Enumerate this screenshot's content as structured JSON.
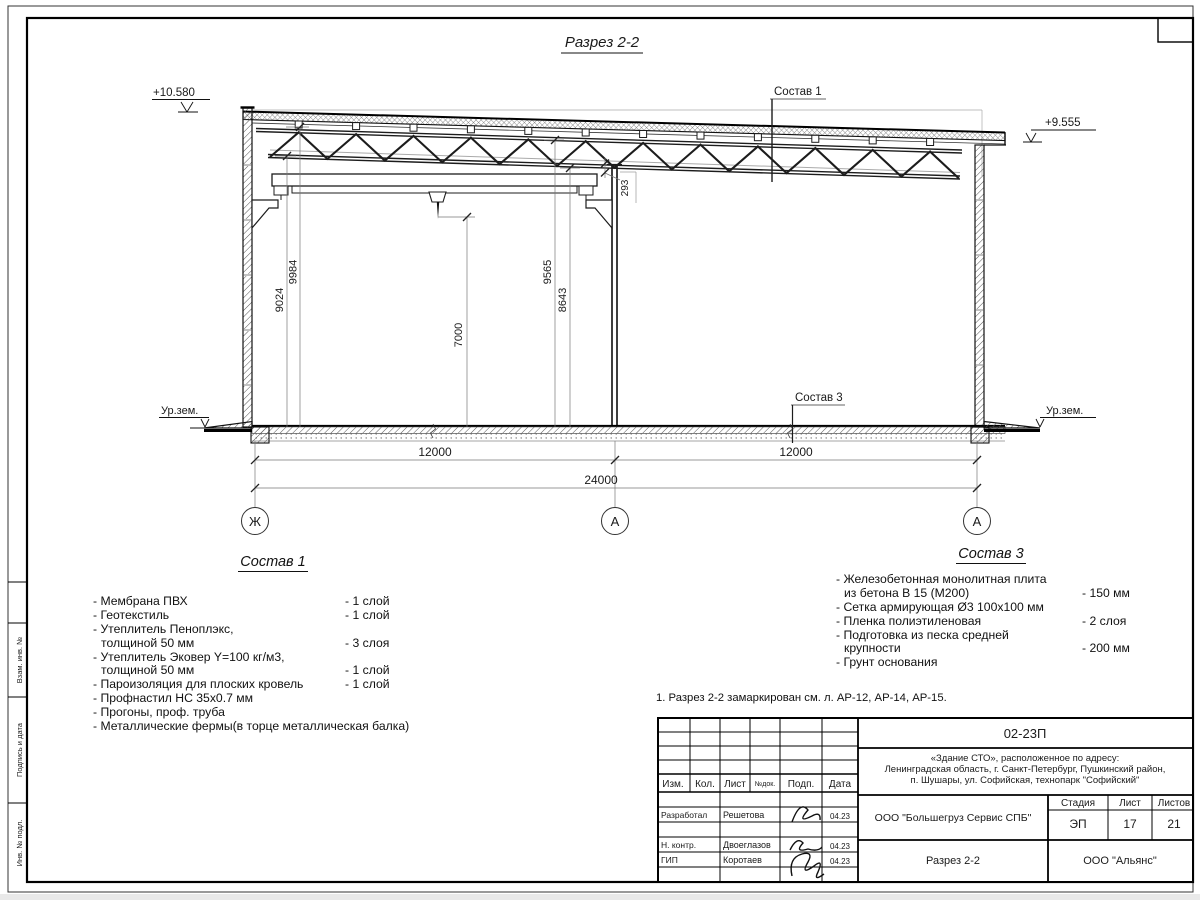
{
  "sheet": {
    "margin_labels": [
      "Взам. инв. №",
      "Подпись и дата",
      "Инв. № подл."
    ]
  },
  "drawing": {
    "title": "Разрез 2-2",
    "elev_left": "+10.580",
    "elev_right": "+9.555",
    "ground_left": "Ур.зем.",
    "ground_right": "Ур.зем.",
    "callout_roof": "Состав 1",
    "callout_floor": "Состав 3",
    "dims": {
      "v9024": "9024",
      "v9984": "9984",
      "v7000": "7000",
      "v9565": "9565",
      "v8643": "8643",
      "v293": "293",
      "bay1": "12000",
      "bay2": "12000",
      "total": "24000"
    },
    "grids": [
      "Ж",
      "А",
      "А"
    ]
  },
  "comp1": {
    "title": "Состав 1",
    "rows": [
      {
        "n": "- Мембрана ПВХ",
        "q": "- 1 слой"
      },
      {
        "n": "- Геотекстиль",
        "q": "- 1 слой"
      },
      {
        "n": "- Утеплитель Пеноплэкс,",
        "q": ""
      },
      {
        "n": "толщиной 50 мм",
        "q": "- 3 слоя"
      },
      {
        "n": "- Утеплитель Эковер Y=100 кг/м3,",
        "q": ""
      },
      {
        "n": "толщиной 50 мм",
        "q": "- 1 слой"
      },
      {
        "n": "- Пароизоляция для плоских кровель",
        "q": "- 1 слой"
      },
      {
        "n": "- Профнастил НС 35х0.7 мм",
        "q": ""
      },
      {
        "n": "- Прогоны, проф. труба",
        "q": ""
      },
      {
        "n": "- Металлические фермы(в торце металлическая балка)",
        "q": ""
      }
    ]
  },
  "comp3": {
    "title": "Состав 3",
    "rows": [
      {
        "n": "- Железобетонная  монолитная плита",
        "q": ""
      },
      {
        "n": "из бетона В 15 (М200)",
        "q": "- 150 мм"
      },
      {
        "n": "- Сетка армирующая Ø3 100х100 мм",
        "q": ""
      },
      {
        "n": "- Пленка полиэтиленовая",
        "q": "-  2 слоя"
      },
      {
        "n": "- Подготовка из песка средней",
        "q": ""
      },
      {
        "n": "крупности",
        "q": "- 200 мм"
      },
      {
        "n": "- Грунт основания",
        "q": ""
      }
    ]
  },
  "note": "1. Разрез 2-2 замаркирован см. л. АР-12, АР-14, АР-15.",
  "stamp": {
    "doc_number": "02-23П",
    "object_line1": "«Здание СТО», расположенное по адресу:",
    "object_line2": "Ленинградская область, г. Санкт-Петербург, Пушкинский район,",
    "object_line3": "п. Шушары, ул. Софийская, технопарк \"Софийский\"",
    "cols": {
      "izm": "Изм.",
      "kol": "Кол.",
      "list": "Лист",
      "ndok": "№док.",
      "podp": "Подп.",
      "data": "Дата"
    },
    "roles": [
      {
        "role": "Разработал",
        "name": "Решетова",
        "date": "04.23"
      },
      {
        "role": "Н. контр.",
        "name": "Двоеглазов",
        "date": "04.23"
      },
      {
        "role": "ГИП",
        "name": "Коротаев",
        "date": "04.23"
      }
    ],
    "company": "ООО \"Большегруз Сервис СПБ\"",
    "stage_label": "Стадия",
    "sheet_label": "Лист",
    "sheets_label": "Листов",
    "stage": "ЭП",
    "sheet": "17",
    "sheets": "21",
    "drawing_name": "Разрез 2-2",
    "org": "ООО \"Альянс\""
  }
}
